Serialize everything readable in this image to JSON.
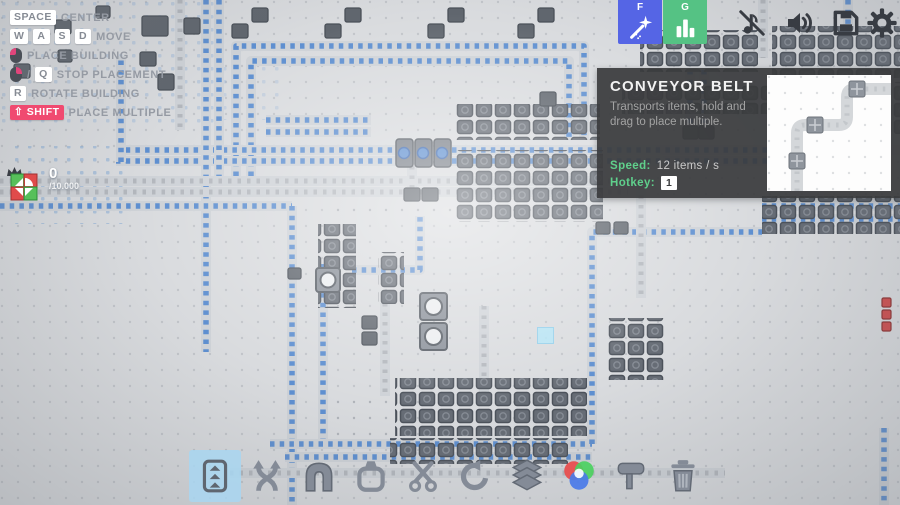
{
  "hints": {
    "center": {
      "key": "SPACE",
      "label": "CENTER"
    },
    "move": {
      "keys": [
        "W",
        "A",
        "S",
        "D"
      ],
      "label": "MOVE"
    },
    "place": {
      "mouse": "left-click",
      "label": "PLACE BUILDING"
    },
    "stop": {
      "mouse": "right-click",
      "separator": "/",
      "key": "Q",
      "label": "STOP PLACEMENT"
    },
    "rotate": {
      "key": "R",
      "label": "ROTATE BUILDING"
    },
    "multiple": {
      "key": "⇧ SHIFT",
      "label": "PLACE MULTIPLE"
    }
  },
  "goal": {
    "count": "0",
    "target": "/10.000",
    "icon": "crowned-shape-icon"
  },
  "top_bar": {
    "wand_button": {
      "key_label": "F",
      "icon": "magic-wand-icon",
      "bg_color": "#5565e5"
    },
    "stats_button": {
      "key_label": "G",
      "icon": "bar-chart-icon",
      "bg_color": "#55c284"
    },
    "music_button": {
      "icon": "music-note-muted-icon"
    },
    "sound_button": {
      "icon": "speaker-icon"
    },
    "save_button": {
      "icon": "floppy-disk-icon"
    },
    "settings_button": {
      "icon": "gear-icon"
    }
  },
  "tooltip": {
    "title": "CONVEYOR BELT",
    "description": "Transports items, hold and drag to place multiple.",
    "speed_label": "Speed:",
    "speed_value": "12 items / s",
    "hotkey_label": "Hotkey:",
    "hotkey_value": "1",
    "accent_color": "#5fd08c"
  },
  "toolbar": {
    "selected_index": 0,
    "selected_color": "#a8d6f1",
    "items": [
      {
        "name": "belt",
        "selected": true
      },
      {
        "name": "balancer",
        "selected": false
      },
      {
        "name": "tunnel",
        "selected": false
      },
      {
        "name": "extractor",
        "selected": false
      },
      {
        "name": "cutter",
        "selected": false
      },
      {
        "name": "rotater",
        "selected": false
      },
      {
        "name": "stacker",
        "selected": false
      },
      {
        "name": "mixer",
        "selected": false
      },
      {
        "name": "painter",
        "selected": false
      },
      {
        "name": "trash",
        "selected": false
      }
    ]
  },
  "colors": {
    "belt_item_blue": "#5e8fd0",
    "belt_track": "#ced2d7",
    "machine_gray": "#60666e",
    "red_item": "#cf4f4f",
    "danger_key_bg": "#f04a70",
    "tooltip_bg": "#3a3b3d"
  }
}
